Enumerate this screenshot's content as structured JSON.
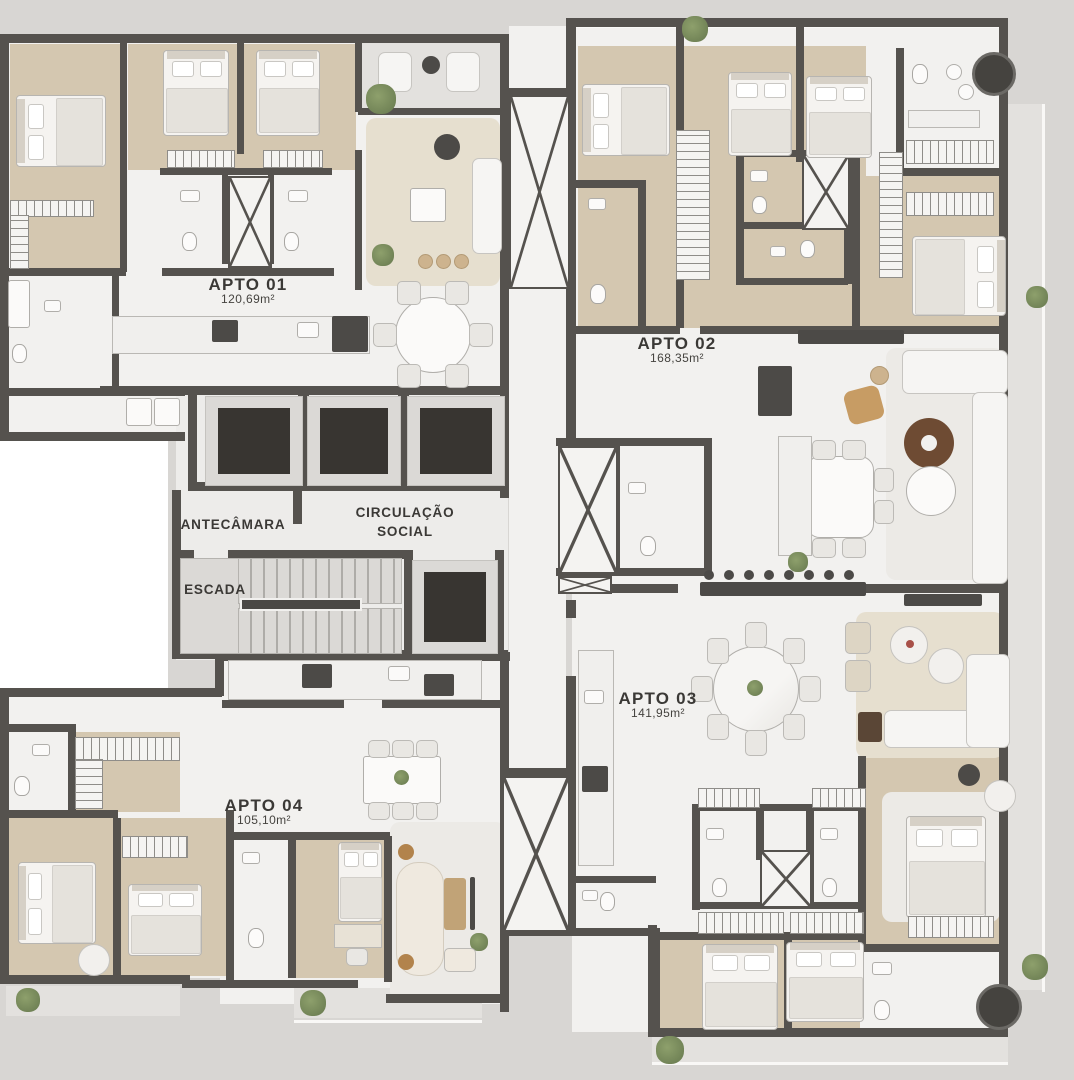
{
  "apartments": [
    {
      "name": "APTO 01",
      "area": "120,69m²"
    },
    {
      "name": "APTO 02",
      "area": "168,35m²"
    },
    {
      "name": "APTO 03",
      "area": "141,95m²"
    },
    {
      "name": "APTO 04",
      "area": "105,10m²"
    }
  ],
  "core": {
    "antechamber": "ANTECÂMARA",
    "circulation_line1": "CIRCULAÇÃO",
    "circulation_line2": "SOCIAL",
    "stairs": "ESCADA"
  },
  "palette": {
    "background": "#d8d6d3",
    "wall": "#55524e",
    "floor_marble": "#f2f1ef",
    "floor_wood": "#d4c7b0",
    "floor_balcony": "#e3e1de",
    "shaft_interior": "#383531",
    "label_text": "#3b3936",
    "coffee_table_wood": "#6e4b33",
    "armchair_tan": "#c79c64",
    "plant_green": "#7c8d60"
  }
}
